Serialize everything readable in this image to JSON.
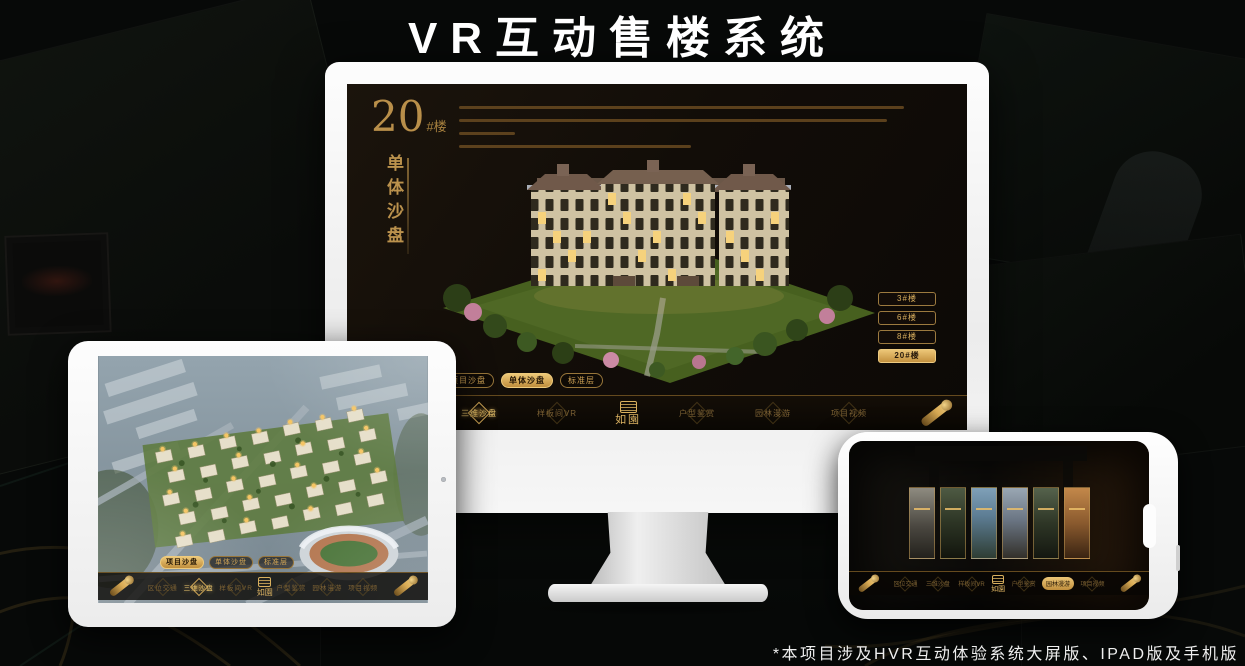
{
  "title": "VR互动售楼系统",
  "footnote": "*本项目涉及HVR互动体验系统大屏版、IPAD版及手机版",
  "colors": {
    "gold": "#c9a05a",
    "gold_bright": "#eecb7d",
    "screen_bg": "#14100b",
    "device_white": "#fdfdfd"
  },
  "logo": {
    "name": "如園"
  },
  "desktop": {
    "building_no": "20",
    "building_suffix": "#楼",
    "section_title_vertical": "单体沙盘",
    "floor_buttons": [
      {
        "label": "3#楼",
        "active": false
      },
      {
        "label": "6#楼",
        "active": false
      },
      {
        "label": "8#楼",
        "active": false
      },
      {
        "label": "20#楼",
        "active": true
      }
    ],
    "tabs": [
      {
        "label": "项目沙盘",
        "active": false
      },
      {
        "label": "单体沙盘",
        "active": true
      },
      {
        "label": "标准层",
        "active": false
      }
    ],
    "nav": [
      {
        "label": "区位交通",
        "active": false
      },
      {
        "label": "三维沙盘",
        "active": true
      },
      {
        "label": "样板间VR",
        "active": false
      },
      {
        "label": "户型鉴赏",
        "active": false
      },
      {
        "label": "园林漫游",
        "active": false
      },
      {
        "label": "项目视频",
        "active": false
      }
    ]
  },
  "tablet": {
    "tabs": [
      {
        "label": "项目沙盘",
        "active": true
      },
      {
        "label": "单体沙盘",
        "active": false
      },
      {
        "label": "标准层",
        "active": false
      }
    ],
    "nav": [
      {
        "label": "区位交通",
        "active": false
      },
      {
        "label": "三维沙盘",
        "active": true
      },
      {
        "label": "样板间VR",
        "active": false
      },
      {
        "label": "户型鉴赏",
        "active": false
      },
      {
        "label": "园林漫游",
        "active": false
      },
      {
        "label": "项目视频",
        "active": false
      }
    ]
  },
  "phone": {
    "nav": [
      {
        "label": "区位交通",
        "active": false
      },
      {
        "label": "三维沙盘",
        "active": false
      },
      {
        "label": "样板间VR",
        "active": false
      },
      {
        "label": "户型鉴赏",
        "active": false
      },
      {
        "label": "园林漫游",
        "active": true
      },
      {
        "label": "项目视频",
        "active": false
      }
    ]
  }
}
